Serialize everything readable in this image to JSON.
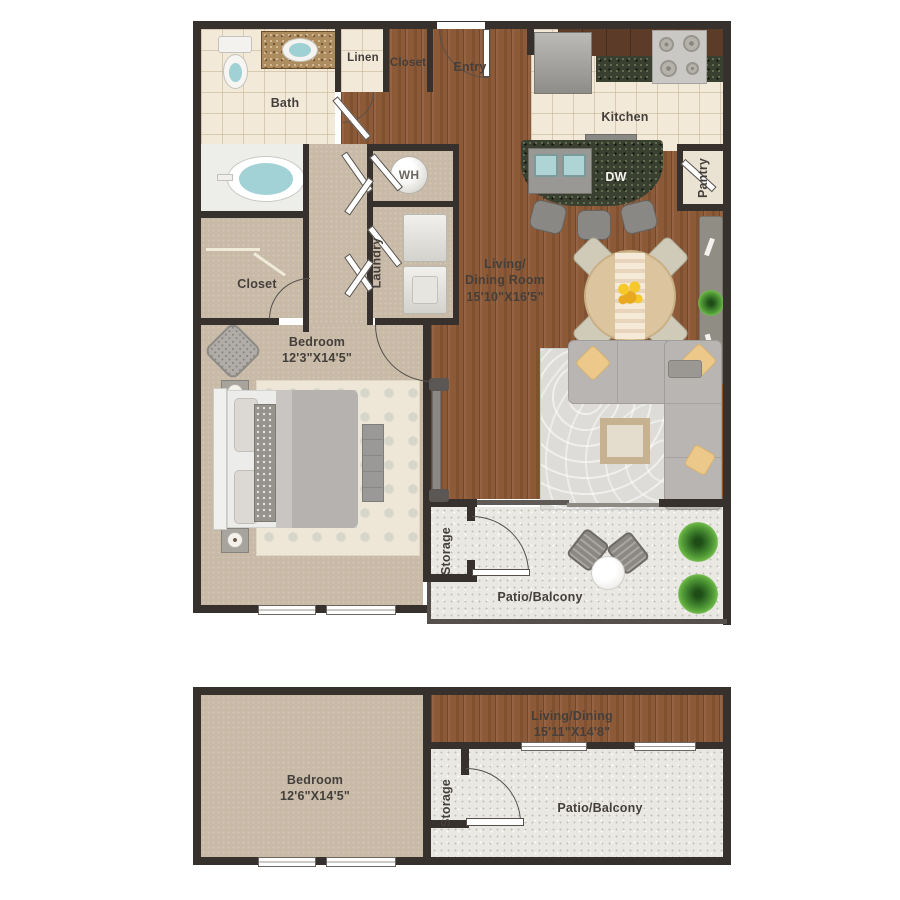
{
  "colors": {
    "wall": "#36312d",
    "wood_floor": "#8d5a38",
    "tile_floor": "#f2e9d9",
    "carpet_floor": "#c8baa7",
    "concrete_floor": "#e9e8e3",
    "granite_dark": "#3a4030",
    "granite_tan": "#ad8d5f",
    "water_blue": "#9fd0d4",
    "pillow_yellow": "#ecc98a",
    "plant_green": "#3c7d2b"
  },
  "plan_upper": {
    "rooms": {
      "bath": "Bath",
      "linen": "Linen",
      "closet_entry": "Closet",
      "entry": "Entry",
      "kitchen": "Kitchen",
      "pantry": "Pantry",
      "dishwasher": "DW",
      "water_heater": "WH",
      "laundry": "Laundry",
      "living_line1": "Living/",
      "living_line2": "Dining Room",
      "living_dims": "15'10\"X16'5\"",
      "closet_bedroom": "Closet",
      "bedroom": "Bedroom",
      "bedroom_dims": "12'3\"X14'5\"",
      "storage": "Storage",
      "patio": "Patio/Balcony"
    }
  },
  "plan_lower": {
    "rooms": {
      "bedroom": "Bedroom",
      "bedroom_dims": "12'6\"X14'5\"",
      "living_dining": "Living/Dining",
      "living_dims": "15'11\"X14'8\"",
      "storage": "Storage",
      "patio": "Patio/Balcony"
    }
  }
}
